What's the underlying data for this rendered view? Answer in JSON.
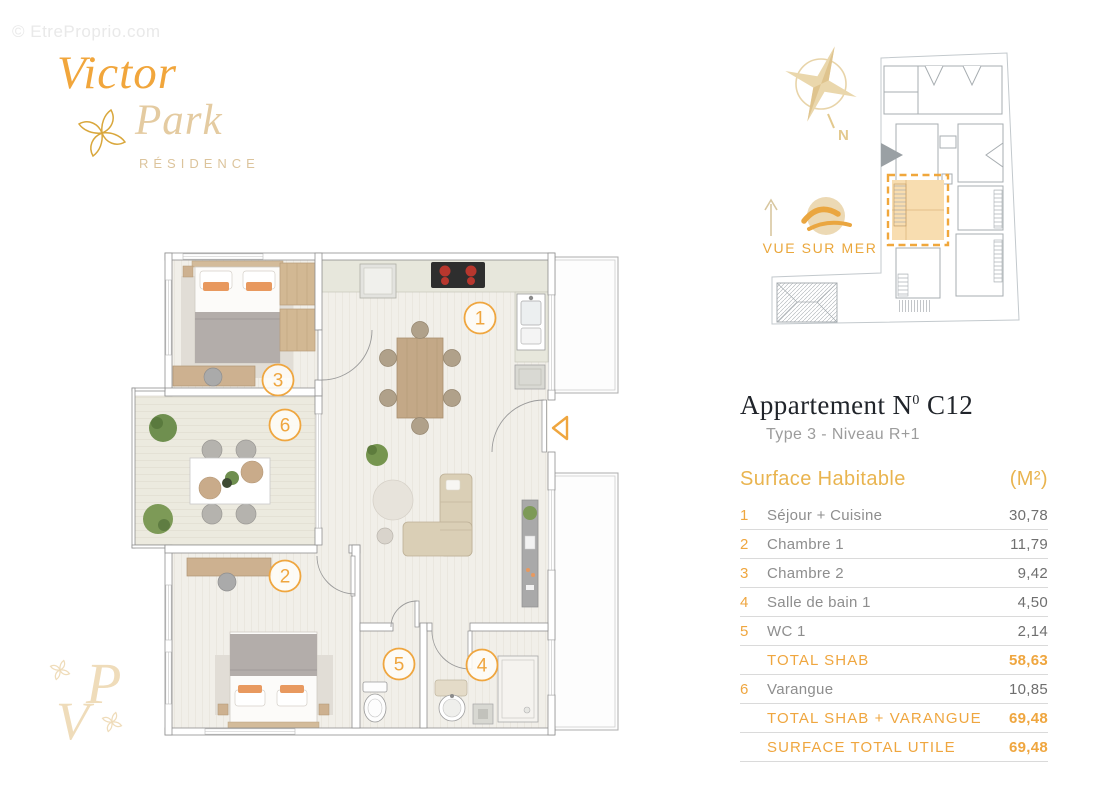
{
  "watermark": "© EtreProprio.com",
  "brand": {
    "name_top": "Victor",
    "name_bottom": "Park",
    "tagline": "RÉSIDENCE",
    "monogram_v": "V",
    "monogram_p": "P"
  },
  "location": {
    "north_label": "N",
    "sea_view_label": "VUE SUR MER"
  },
  "apartment": {
    "title_prefix": "Appartement N",
    "title_sup": "0",
    "title_number": "C12",
    "subtitle": "Type 3 - Niveau R+1"
  },
  "surface_table": {
    "header": "Surface Habitable",
    "unit": "(M²)",
    "rows": [
      {
        "num": "1",
        "label": "Séjour + Cuisine",
        "value": "30,78"
      },
      {
        "num": "2",
        "label": "Chambre 1",
        "value": "11,79"
      },
      {
        "num": "3",
        "label": "Chambre 2",
        "value": "9,42"
      },
      {
        "num": "4",
        "label": "Salle de bain 1",
        "value": "4,50"
      },
      {
        "num": "5",
        "label": "WC 1",
        "value": "2,14"
      },
      {
        "num": "",
        "label": "TOTAL SHAB",
        "value": "58,63"
      },
      {
        "num": "6",
        "label": "Varangue",
        "value": "10,85"
      },
      {
        "num": "",
        "label": "TOTAL SHAB + VARANGUE",
        "value": "69,48"
      },
      {
        "num": "",
        "label": "SURFACE TOTAL UTILE",
        "value": "69,48"
      }
    ]
  },
  "plan": {
    "markers": [
      {
        "n": "1"
      },
      {
        "n": "2"
      },
      {
        "n": "3"
      },
      {
        "n": "4"
      },
      {
        "n": "5"
      },
      {
        "n": "6"
      }
    ]
  },
  "colors": {
    "accent": "#EFA63F",
    "gold_header": "#E9B44F",
    "tan": "#E4CBA1",
    "compass_tan": "#E8D4A9"
  }
}
